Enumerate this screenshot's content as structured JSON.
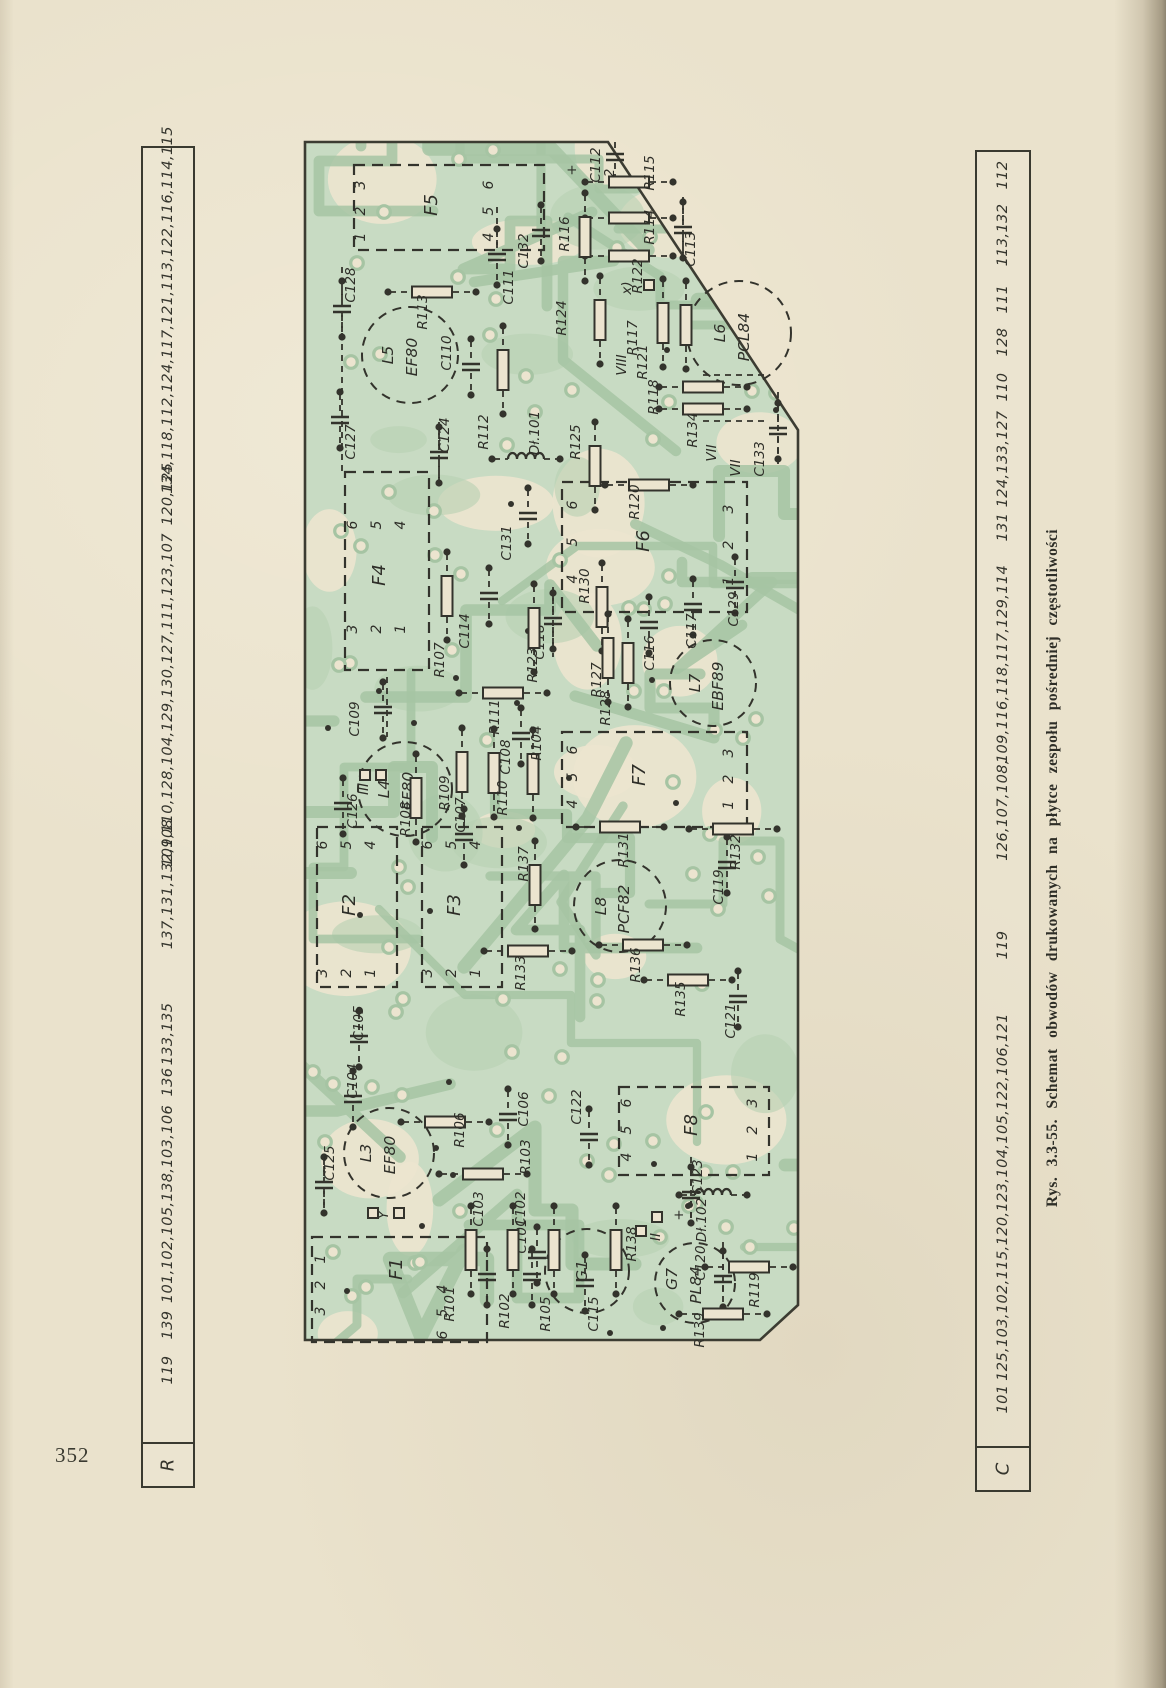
{
  "colors": {
    "paper": "#eae2cc",
    "ink": "#33332c",
    "board_green": "#c8dbc3",
    "board_paper": "#ece4cf",
    "trace_green": "#a6c4a3",
    "blob_green": "#b7d0b2",
    "outline": "#3c3c32",
    "label_ink": "#2e2e28"
  },
  "page": {
    "number": "352"
  },
  "caption": {
    "text": "Rys. 3.3-55. Schemat obwodów drukowanych na płytce zespołu pośredniej częstotliwości"
  },
  "r_table": {
    "header": "R",
    "groups": [
      {
        "text": "134,118,112,124,117,121,113,122,116,114,115",
        "y": 162
      },
      {
        "text": "120,125",
        "y": 346
      },
      {
        "text": "109,110,128,104,129,130,127,111,123,107",
        "y": 552
      },
      {
        "text": "137,131,132,108",
        "y": 736
      },
      {
        "text": "133,135",
        "y": 886
      },
      {
        "text": "136",
        "y": 934
      },
      {
        "text": "101,102,105,138,103,106",
        "y": 1056
      },
      {
        "text": "139",
        "y": 1177
      },
      {
        "text": "119",
        "y": 1222
      }
    ]
  },
  "c_table": {
    "header": "C",
    "groups": [
      {
        "text": "112",
        "y": 23
      },
      {
        "text": "113,132",
        "y": 83
      },
      {
        "text": "111",
        "y": 147
      },
      {
        "text": "128",
        "y": 190
      },
      {
        "text": "110",
        "y": 235
      },
      {
        "text": "124,133,127",
        "y": 307
      },
      {
        "text": "131",
        "y": 375
      },
      {
        "text": "109,116,118,117,129,114",
        "y": 512
      },
      {
        "text": "126,107,108,",
        "y": 658
      },
      {
        "text": "119",
        "y": 793
      },
      {
        "text": "125,103,102,115,120,123,104,105,122,106,121",
        "y": 1045
      },
      {
        "text": "101",
        "y": 1247
      }
    ]
  },
  "pcb": {
    "connectors": [
      {
        "label": "F5",
        "x": 57,
        "y": 28,
        "w": 190,
        "h": 85,
        "label_pos": [
          140,
          68
        ],
        "pins": [
          [
            "3",
            68,
            48
          ],
          [
            "2",
            68,
            74
          ],
          [
            "1",
            68,
            100
          ],
          [
            "6",
            196,
            48
          ],
          [
            "5",
            196,
            74
          ],
          [
            "4",
            196,
            100
          ]
        ]
      },
      {
        "label": "F4",
        "x": 48,
        "y": 335,
        "w": 84,
        "h": 198,
        "label_pos": [
          88,
          438
        ],
        "pins": [
          [
            "6",
            60,
            388
          ],
          [
            "5",
            84,
            388
          ],
          [
            "4",
            108,
            388
          ],
          [
            "3",
            60,
            492
          ],
          [
            "2",
            84,
            492
          ],
          [
            "1",
            108,
            492
          ]
        ]
      },
      {
        "label": "F6",
        "x": 265,
        "y": 345,
        "w": 185,
        "h": 130,
        "label_pos": [
          352,
          404
        ],
        "pins": [
          [
            "6",
            280,
            368
          ],
          [
            "5",
            280,
            405
          ],
          [
            "4",
            280,
            442
          ],
          [
            "3",
            436,
            372
          ],
          [
            "2",
            436,
            408
          ],
          [
            "1",
            436,
            444
          ]
        ]
      },
      {
        "label": "F7",
        "x": 265,
        "y": 595,
        "w": 185,
        "h": 95,
        "label_pos": [
          348,
          638
        ],
        "pins": [
          [
            "6",
            280,
            613
          ],
          [
            "5",
            280,
            640
          ],
          [
            "4",
            280,
            667
          ],
          [
            "3",
            436,
            616
          ],
          [
            "2",
            436,
            642
          ],
          [
            "1",
            436,
            668
          ]
        ]
      },
      {
        "label": "F2",
        "x": 20,
        "y": 690,
        "w": 80,
        "h": 160,
        "label_pos": [
          58,
          768
        ],
        "pins": [
          [
            "6",
            30,
            708
          ],
          [
            "5",
            54,
            708
          ],
          [
            "4",
            78,
            708
          ],
          [
            "3",
            30,
            836
          ],
          [
            "2",
            54,
            836
          ],
          [
            "1",
            78,
            836
          ]
        ]
      },
      {
        "label": "F3",
        "x": 125,
        "y": 690,
        "w": 80,
        "h": 160,
        "label_pos": [
          163,
          768
        ],
        "pins": [
          [
            "6",
            135,
            708
          ],
          [
            "5",
            159,
            708
          ],
          [
            "4",
            183,
            708
          ],
          [
            "3",
            135,
            836
          ],
          [
            "2",
            159,
            836
          ],
          [
            "1",
            183,
            836
          ]
        ]
      },
      {
        "label": "F8",
        "x": 322,
        "y": 950,
        "w": 150,
        "h": 88,
        "label_pos": [
          400,
          988
        ],
        "pins": [
          [
            "6",
            334,
            966
          ],
          [
            "5",
            334,
            993
          ],
          [
            "4",
            334,
            1020
          ],
          [
            "3",
            460,
            966
          ],
          [
            "2",
            460,
            993
          ],
          [
            "1",
            460,
            1020
          ]
        ]
      },
      {
        "label": "F1",
        "x": 15,
        "y": 1100,
        "w": 175,
        "h": 105,
        "label_pos": [
          105,
          1132
        ],
        "pins": [
          [
            "1",
            28,
            1122
          ],
          [
            "2",
            28,
            1148
          ],
          [
            "3",
            28,
            1174
          ],
          [
            "4",
            150,
            1152
          ],
          [
            "5",
            150,
            1176
          ],
          [
            "6",
            150,
            1198
          ]
        ]
      }
    ],
    "tubes": [
      {
        "name": "L5",
        "labels": [
          [
            "L5",
            96,
            218
          ],
          [
            "EF80",
            120,
            220
          ]
        ],
        "cx": 113,
        "cy": 218,
        "r": 48
      },
      {
        "name": "L4",
        "labels": [
          [
            "L4",
            92,
            652
          ],
          [
            "EF80",
            116,
            654
          ]
        ],
        "cx": 108,
        "cy": 652,
        "r": 47
      },
      {
        "name": "L3",
        "labels": [
          [
            "L3",
            74,
            1016
          ],
          [
            "EF80",
            98,
            1018
          ]
        ],
        "cx": 92,
        "cy": 1016,
        "r": 45
      },
      {
        "name": "L6",
        "labels": [
          [
            "L6",
            428,
            196
          ],
          [
            "PCL84",
            452,
            200
          ]
        ],
        "cx": 442,
        "cy": 196,
        "r": 52
      },
      {
        "name": "L7",
        "labels": [
          [
            "L7",
            403,
            546
          ],
          [
            "EBF89",
            426,
            549
          ]
        ],
        "cx": 416,
        "cy": 546,
        "r": 43
      },
      {
        "name": "L8",
        "labels": [
          [
            "L8",
            309,
            769
          ],
          [
            "PCF82",
            332,
            772
          ]
        ],
        "cx": 323,
        "cy": 769,
        "r": 46
      },
      {
        "name": "G1",
        "labels": [
          [
            "G1",
            290,
            1134
          ]
        ],
        "cx": 290,
        "cy": 1134,
        "r": 42
      },
      {
        "name": "G7",
        "labels": [
          [
            "G7",
            380,
            1142
          ],
          [
            "PL84",
            404,
            1148
          ]
        ],
        "cx": 398,
        "cy": 1146,
        "r": 40
      }
    ],
    "components": [
      [
        "C128",
        "c",
        45,
        172,
        58,
        148
      ],
      [
        "C127",
        "c",
        43,
        283,
        58,
        305
      ],
      [
        "C111",
        "c",
        200,
        120,
        216,
        150
      ],
      [
        "C110",
        "c",
        174,
        230,
        154,
        216
      ],
      [
        "C124",
        "c",
        142,
        318,
        152,
        298
      ],
      [
        "C132",
        "c",
        244,
        96,
        231,
        114
      ],
      [
        "C112",
        "c",
        318,
        20,
        303,
        28
      ],
      [
        "C113",
        "c",
        386,
        93,
        398,
        112
      ],
      [
        "C133",
        "c",
        481,
        294,
        467,
        322
      ],
      [
        "C131",
        "c",
        231,
        379,
        214,
        406
      ],
      [
        "C114",
        "c",
        192,
        459,
        172,
        494
      ],
      [
        "C109",
        "c",
        86,
        573,
        62,
        582
      ],
      [
        "C126",
        "c",
        46,
        669,
        60,
        674
      ],
      [
        "C107",
        "c",
        167,
        700,
        168,
        678
      ],
      [
        "C108",
        "c",
        224,
        599,
        213,
        620
      ],
      [
        "C118",
        "c",
        256,
        484,
        247,
        505
      ],
      [
        "C116",
        "c",
        352,
        488,
        357,
        516
      ],
      [
        "C117",
        "c",
        396,
        470,
        399,
        494
      ],
      [
        "C129",
        "c",
        438,
        448,
        441,
        472
      ],
      [
        "C119",
        "c",
        430,
        728,
        426,
        750
      ],
      [
        "C121",
        "c",
        441,
        862,
        438,
        884
      ],
      [
        "C105",
        "c",
        62,
        902,
        66,
        886
      ],
      [
        "C104",
        "c",
        56,
        962,
        60,
        944
      ],
      [
        "C106",
        "c",
        211,
        980,
        231,
        972
      ],
      [
        "C122",
        "c",
        292,
        1000,
        284,
        970
      ],
      [
        "C103",
        "c",
        190,
        1140,
        186,
        1072
      ],
      [
        "C102",
        "c",
        235,
        1140,
        228,
        1072
      ],
      [
        "C115",
        "c",
        288,
        1146,
        301,
        1177
      ],
      [
        "C120",
        "c",
        426,
        1142,
        408,
        1126
      ],
      [
        "C123",
        "c",
        394,
        1058,
        405,
        1040
      ],
      [
        "C101",
        "c",
        240,
        1118,
        229,
        1099
      ],
      [
        "C125",
        "c",
        27,
        1048,
        37,
        1026
      ],
      [
        "R115",
        "rh",
        332,
        45,
        357,
        36
      ],
      [
        "R114",
        "rh",
        332,
        81,
        357,
        90
      ],
      [
        "R122",
        "rh",
        332,
        119,
        345,
        139
      ],
      [
        "R113",
        "rh",
        135,
        155,
        130,
        175
      ],
      [
        "R118",
        "rh",
        406,
        250,
        361,
        260
      ],
      [
        "R134",
        "rh",
        406,
        272,
        400,
        293
      ],
      [
        "R120",
        "rh",
        352,
        348,
        342,
        365
      ],
      [
        "R131",
        "rh",
        323,
        690,
        331,
        713
      ],
      [
        "R132",
        "rh",
        436,
        692,
        443,
        715
      ],
      [
        "R133",
        "rh",
        231,
        814,
        228,
        836
      ],
      [
        "R136",
        "rh",
        346,
        808,
        343,
        828
      ],
      [
        "R135",
        "rh",
        391,
        843,
        388,
        862
      ],
      [
        "R103",
        "rh",
        186,
        1037,
        233,
        1020
      ],
      [
        "R106",
        "rh",
        148,
        985,
        167,
        993
      ],
      [
        "R139",
        "rh",
        426,
        1177,
        407,
        1193
      ],
      [
        "R119",
        "rh",
        452,
        1130,
        462,
        1153
      ],
      [
        "R111",
        "rh",
        206,
        556,
        202,
        580
      ],
      [
        "R116",
        "rv",
        288,
        100,
        272,
        97
      ],
      [
        "R124",
        "rv",
        303,
        183,
        269,
        181
      ],
      [
        "R117",
        "rv",
        366,
        186,
        340,
        201
      ],
      [
        "R121",
        "rv",
        389,
        188,
        350,
        225
      ],
      [
        "R112",
        "rv",
        206,
        233,
        191,
        295
      ],
      [
        "R125",
        "rv",
        298,
        329,
        283,
        305
      ],
      [
        "R107",
        "rv",
        150,
        459,
        147,
        523
      ],
      [
        "R123",
        "rv",
        237,
        491,
        240,
        528
      ],
      [
        "R104",
        "rv",
        236,
        637,
        244,
        606
      ],
      [
        "R110",
        "rv",
        197,
        636,
        210,
        661
      ],
      [
        "R109",
        "rv",
        165,
        635,
        152,
        656
      ],
      [
        "R108",
        "rv",
        119,
        661,
        113,
        682
      ],
      [
        "R130",
        "rv",
        305,
        470,
        292,
        449
      ],
      [
        "R127",
        "rv",
        311,
        521,
        304,
        543
      ],
      [
        "R128",
        "rv",
        331,
        526,
        313,
        571
      ],
      [
        "R137",
        "rv",
        238,
        748,
        231,
        727
      ],
      [
        "R101",
        "rv",
        174,
        1113,
        157,
        1167
      ],
      [
        "R102",
        "rv",
        216,
        1113,
        212,
        1174
      ],
      [
        "R105",
        "rv",
        257,
        1113,
        253,
        1177
      ],
      [
        "R138",
        "rv",
        319,
        1113,
        339,
        1107
      ],
      [
        "Dł.101",
        "l",
        229,
        322,
        242,
        296
      ],
      [
        "Dł.102",
        "l",
        416,
        1058,
        409,
        1083
      ]
    ],
    "annotations": [
      [
        "VIII",
        329,
        228
      ],
      [
        "VII",
        419,
        316
      ],
      [
        "VII",
        443,
        331
      ],
      [
        "x)",
        334,
        151
      ],
      [
        "II",
        363,
        1100
      ],
      [
        "III",
        71,
        652
      ],
      [
        "Y",
        91,
        1078
      ],
      [
        "2",
        317,
        36
      ],
      [
        "+",
        279,
        33
      ],
      [
        "+",
        386,
        1078
      ]
    ],
    "squares": [
      [
        352,
        148
      ],
      [
        68,
        638
      ],
      [
        84,
        638
      ],
      [
        76,
        1076
      ],
      [
        102,
        1076
      ],
      [
        344,
        1094
      ],
      [
        360,
        1080
      ]
    ]
  }
}
